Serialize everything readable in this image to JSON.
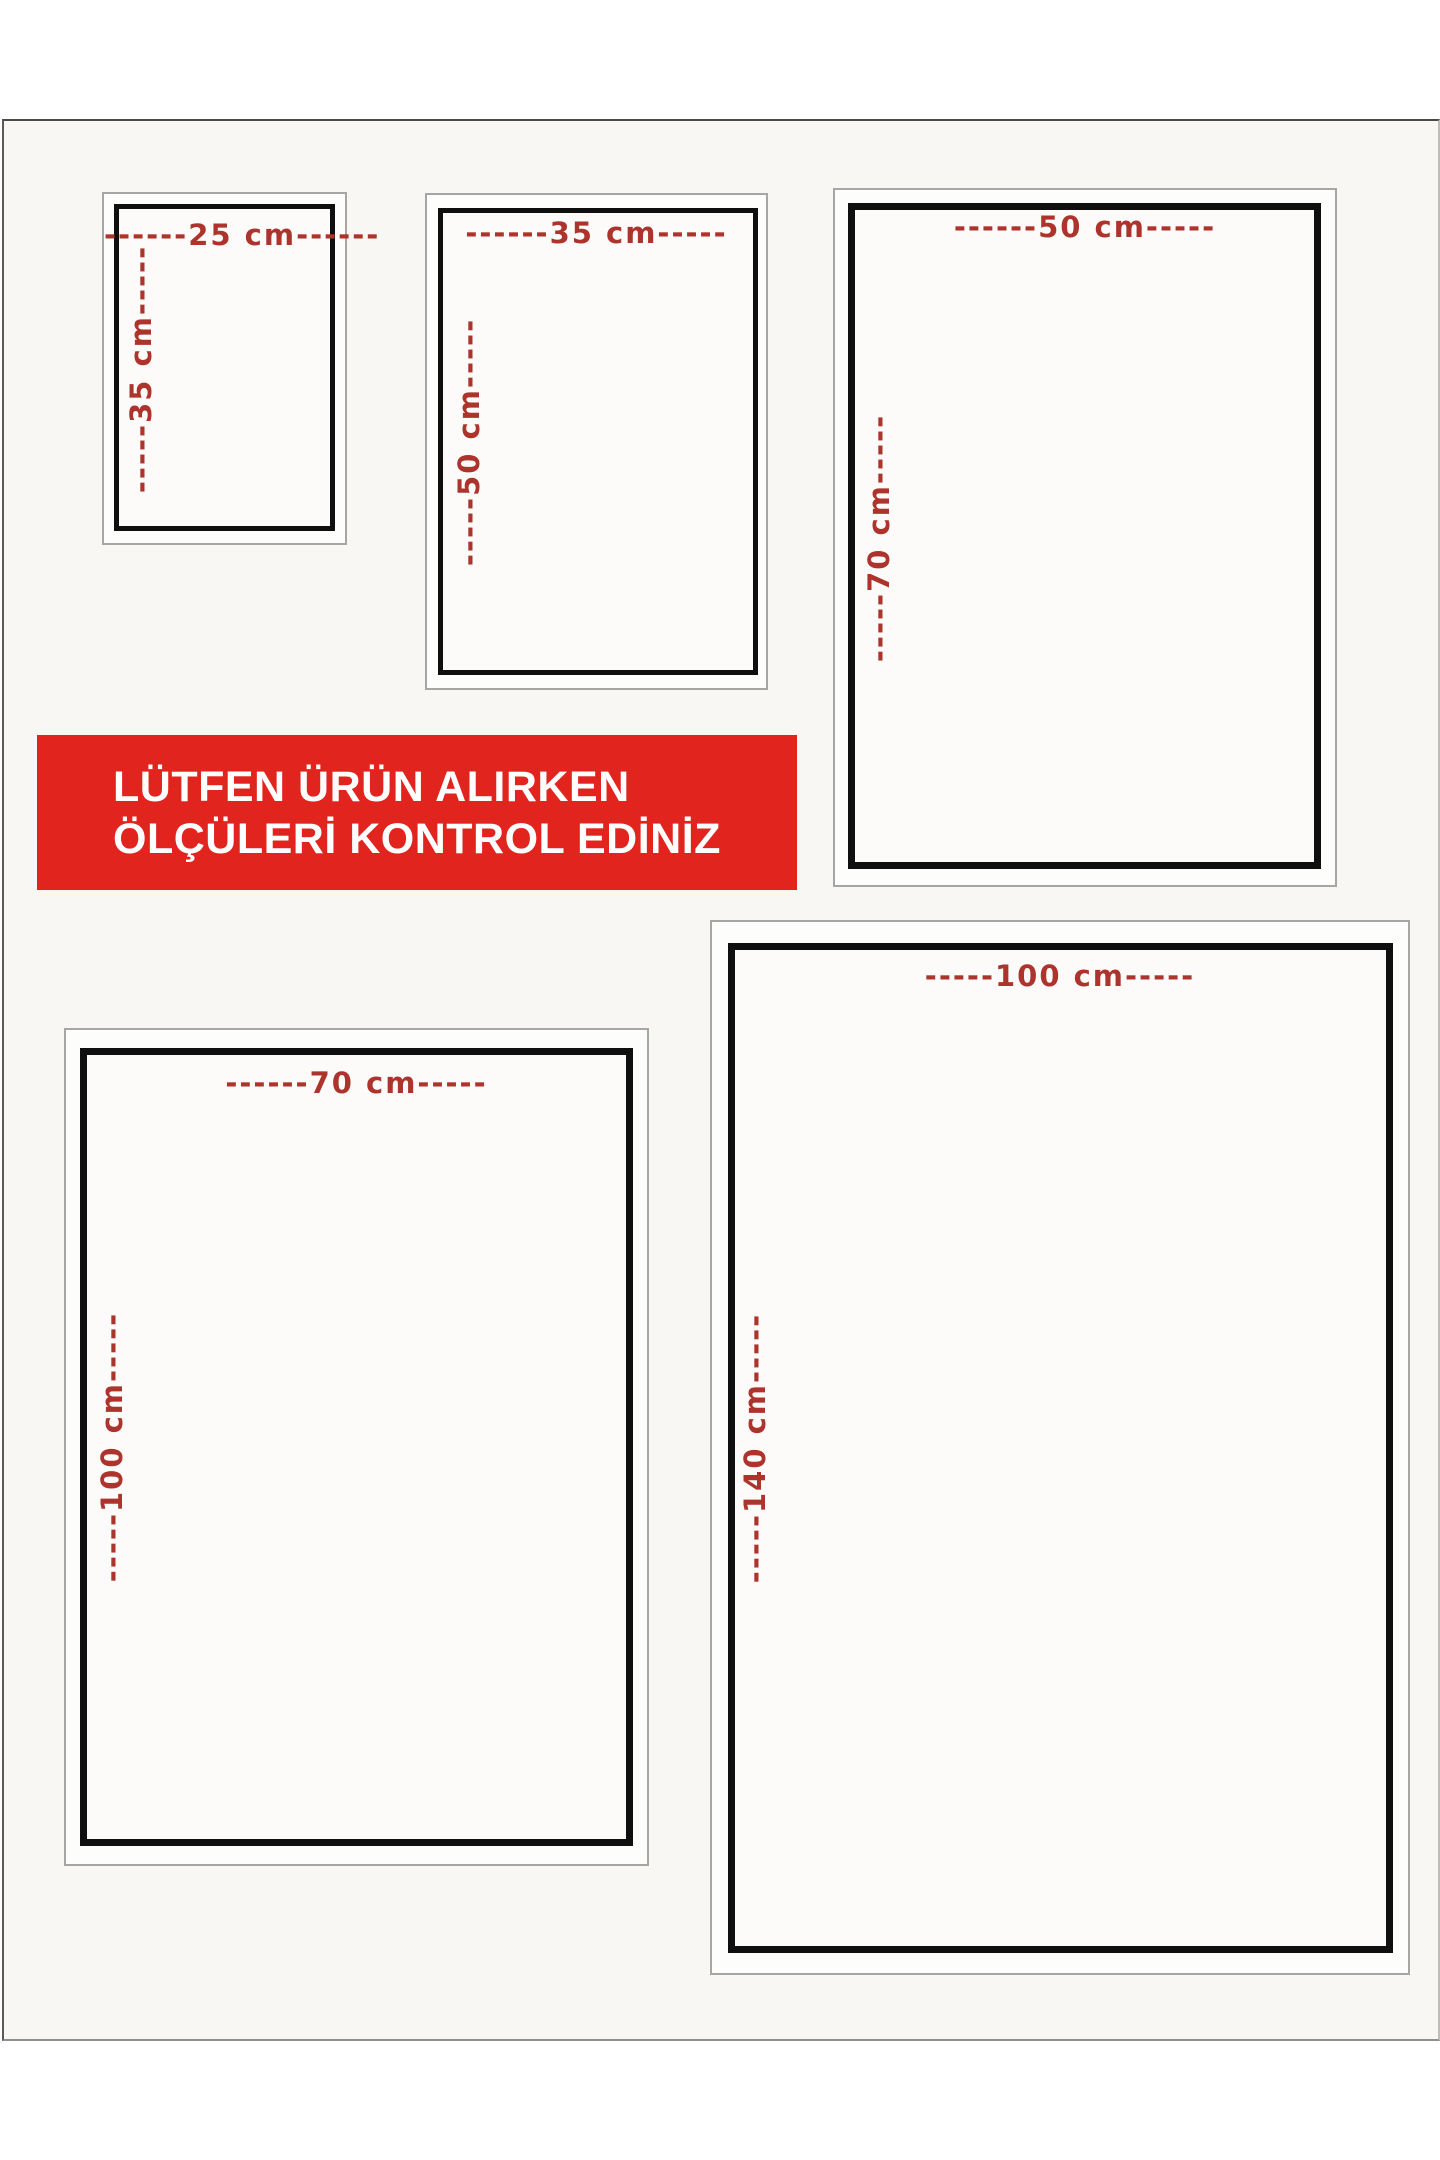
{
  "page": {
    "background": "#ffffff",
    "panel_background": "#f8f7f4",
    "label_red": "#ad342c",
    "banner_red": "#e1241e",
    "border_black": "#0f0f0f"
  },
  "banner": {
    "line1": "LÜTFEN ÜRÜN ALIRKEN",
    "line2": "ÖLÇÜLERİ KONTROL EDİNİZ",
    "text_color": "#ffffff",
    "background": "#e1241e"
  },
  "size_boxes": [
    {
      "name": "25x35",
      "width_cm": 25,
      "height_cm": 35,
      "width_label": "------25 cm------",
      "height_label": "-----35 cm-----"
    },
    {
      "name": "35x50",
      "width_cm": 35,
      "height_cm": 50,
      "width_label": "------35 cm-----",
      "height_label": "-----50 cm-----"
    },
    {
      "name": "50x70",
      "width_cm": 50,
      "height_cm": 70,
      "width_label": "------50 cm-----",
      "height_label": "-----70 cm-----"
    },
    {
      "name": "70x100",
      "width_cm": 70,
      "height_cm": 100,
      "width_label": "------70 cm-----",
      "height_label": "-----100 cm-----"
    },
    {
      "name": "100x140",
      "width_cm": 100,
      "height_cm": 140,
      "width_label": "-----100 cm-----",
      "height_label": "-----140 cm-----"
    }
  ]
}
